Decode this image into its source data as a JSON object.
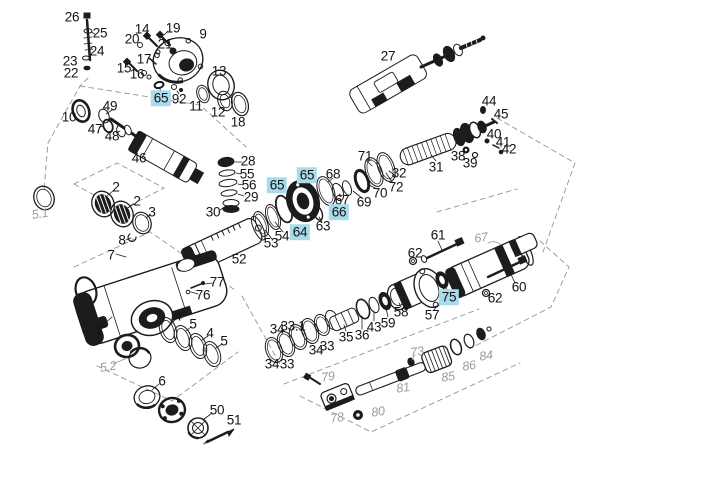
{
  "canvas": {
    "width": 720,
    "height": 501,
    "background": "#ffffff"
  },
  "legend": {
    "highlight_color": "#a9dbec",
    "label_color": "#141414",
    "ghost_label_color": "#9b9b9b",
    "line_color": "#1c1c1c",
    "highlighted_part_numbers": [
      "65",
      "66",
      "64",
      "75"
    ]
  },
  "part_labels": [
    {
      "text": "26",
      "x": 72,
      "y": 17,
      "variant": "normal"
    },
    {
      "text": "25",
      "x": 100,
      "y": 33,
      "variant": "normal"
    },
    {
      "text": "24",
      "x": 97,
      "y": 51,
      "variant": "normal"
    },
    {
      "text": "23",
      "x": 70,
      "y": 61,
      "variant": "normal"
    },
    {
      "text": "22",
      "x": 71,
      "y": 73,
      "variant": "normal"
    },
    {
      "text": "14",
      "x": 142,
      "y": 29,
      "variant": "normal"
    },
    {
      "text": "20",
      "x": 132,
      "y": 39,
      "variant": "normal"
    },
    {
      "text": "19",
      "x": 173,
      "y": 28,
      "variant": "normal"
    },
    {
      "text": "21",
      "x": 165,
      "y": 44,
      "variant": "normal"
    },
    {
      "text": "9",
      "x": 203,
      "y": 34,
      "variant": "normal"
    },
    {
      "text": "17",
      "x": 144,
      "y": 59,
      "variant": "normal"
    },
    {
      "text": "15",
      "x": 124,
      "y": 68,
      "variant": "normal"
    },
    {
      "text": "16",
      "x": 137,
      "y": 74,
      "variant": "normal"
    },
    {
      "text": "13",
      "x": 219,
      "y": 71,
      "variant": "normal"
    },
    {
      "text": "65",
      "x": 161,
      "y": 98,
      "variant": "highlighted"
    },
    {
      "text": "92",
      "x": 179,
      "y": 99,
      "variant": "normal"
    },
    {
      "text": "11",
      "x": 196,
      "y": 106,
      "variant": "normal"
    },
    {
      "text": "12",
      "x": 218,
      "y": 112,
      "variant": "normal"
    },
    {
      "text": "18",
      "x": 238,
      "y": 122,
      "variant": "normal"
    },
    {
      "text": "10",
      "x": 69,
      "y": 117,
      "variant": "normal"
    },
    {
      "text": "49",
      "x": 110,
      "y": 106,
      "variant": "normal"
    },
    {
      "text": "47",
      "x": 95,
      "y": 129,
      "variant": "normal"
    },
    {
      "text": "48",
      "x": 112,
      "y": 136,
      "variant": "normal"
    },
    {
      "text": "46",
      "x": 139,
      "y": 158,
      "variant": "normal"
    },
    {
      "text": "27",
      "x": 388,
      "y": 56,
      "variant": "normal"
    },
    {
      "text": "44",
      "x": 489,
      "y": 101,
      "variant": "normal"
    },
    {
      "text": "45",
      "x": 501,
      "y": 114,
      "variant": "normal"
    },
    {
      "text": "40",
      "x": 494,
      "y": 134,
      "variant": "normal"
    },
    {
      "text": "41",
      "x": 503,
      "y": 142,
      "variant": "normal"
    },
    {
      "text": "42",
      "x": 509,
      "y": 149,
      "variant": "normal"
    },
    {
      "text": "38",
      "x": 458,
      "y": 156,
      "variant": "normal"
    },
    {
      "text": "39",
      "x": 470,
      "y": 163,
      "variant": "normal"
    },
    {
      "text": "31",
      "x": 436,
      "y": 167,
      "variant": "normal"
    },
    {
      "text": "71",
      "x": 365,
      "y": 156,
      "variant": "normal"
    },
    {
      "text": "32",
      "x": 399,
      "y": 173,
      "variant": "normal"
    },
    {
      "text": "72",
      "x": 396,
      "y": 187,
      "variant": "normal"
    },
    {
      "text": "70",
      "x": 380,
      "y": 193,
      "variant": "normal"
    },
    {
      "text": "69",
      "x": 364,
      "y": 202,
      "variant": "normal"
    },
    {
      "text": "68",
      "x": 333,
      "y": 174,
      "variant": "normal"
    },
    {
      "text": "67",
      "x": 342,
      "y": 200,
      "variant": "normal"
    },
    {
      "text": "65",
      "x": 307,
      "y": 175,
      "variant": "highlighted"
    },
    {
      "text": "65",
      "x": 277,
      "y": 185,
      "variant": "highlighted"
    },
    {
      "text": "66",
      "x": 339,
      "y": 212,
      "variant": "highlighted"
    },
    {
      "text": "64",
      "x": 300,
      "y": 232,
      "variant": "highlighted"
    },
    {
      "text": "63",
      "x": 323,
      "y": 226,
      "variant": "normal"
    },
    {
      "text": "54",
      "x": 282,
      "y": 236,
      "variant": "normal"
    },
    {
      "text": "53",
      "x": 271,
      "y": 243,
      "variant": "normal"
    },
    {
      "text": "28",
      "x": 248,
      "y": 161,
      "variant": "normal"
    },
    {
      "text": "55",
      "x": 247,
      "y": 174,
      "variant": "normal"
    },
    {
      "text": "56",
      "x": 249,
      "y": 185,
      "variant": "normal"
    },
    {
      "text": "29",
      "x": 251,
      "y": 197,
      "variant": "normal"
    },
    {
      "text": "30",
      "x": 213,
      "y": 212,
      "variant": "normal"
    },
    {
      "text": "2",
      "x": 116,
      "y": 187,
      "variant": "normal"
    },
    {
      "text": "2",
      "x": 137,
      "y": 201,
      "variant": "normal"
    },
    {
      "text": "3",
      "x": 152,
      "y": 212,
      "variant": "normal"
    },
    {
      "text": "8",
      "x": 122,
      "y": 240,
      "variant": "normal"
    },
    {
      "text": "7",
      "x": 111,
      "y": 255,
      "variant": "normal"
    },
    {
      "text": "52",
      "x": 239,
      "y": 259,
      "variant": "normal"
    },
    {
      "text": "77",
      "x": 217,
      "y": 282,
      "variant": "normal"
    },
    {
      "text": "76",
      "x": 203,
      "y": 295,
      "variant": "normal"
    },
    {
      "text": "61",
      "x": 438,
      "y": 235,
      "variant": "normal"
    },
    {
      "text": "62",
      "x": 415,
      "y": 253,
      "variant": "normal"
    },
    {
      "text": "60",
      "x": 519,
      "y": 287,
      "variant": "normal"
    },
    {
      "text": "62",
      "x": 495,
      "y": 298,
      "variant": "normal"
    },
    {
      "text": "75",
      "x": 449,
      "y": 297,
      "variant": "highlighted"
    },
    {
      "text": "57",
      "x": 432,
      "y": 315,
      "variant": "normal"
    },
    {
      "text": "58",
      "x": 401,
      "y": 312,
      "variant": "normal"
    },
    {
      "text": "59",
      "x": 388,
      "y": 323,
      "variant": "normal"
    },
    {
      "text": "43",
      "x": 374,
      "y": 327,
      "variant": "normal"
    },
    {
      "text": "36",
      "x": 362,
      "y": 335,
      "variant": "normal"
    },
    {
      "text": "35",
      "x": 346,
      "y": 337,
      "variant": "normal"
    },
    {
      "text": "34",
      "x": 277,
      "y": 329,
      "variant": "normal"
    },
    {
      "text": "33.1",
      "x": 293,
      "y": 326,
      "variant": "normal"
    },
    {
      "text": "33",
      "x": 327,
      "y": 346,
      "variant": "normal"
    },
    {
      "text": "34",
      "x": 316,
      "y": 350,
      "variant": "normal"
    },
    {
      "text": "33",
      "x": 287,
      "y": 364,
      "variant": "normal"
    },
    {
      "text": "34",
      "x": 272,
      "y": 364,
      "variant": "normal"
    },
    {
      "text": "1",
      "x": 99,
      "y": 329,
      "variant": "normal"
    },
    {
      "text": "4",
      "x": 178,
      "y": 316,
      "variant": "normal"
    },
    {
      "text": "5",
      "x": 193,
      "y": 324,
      "variant": "normal"
    },
    {
      "text": "4",
      "x": 210,
      "y": 333,
      "variant": "normal"
    },
    {
      "text": "5",
      "x": 224,
      "y": 341,
      "variant": "normal"
    },
    {
      "text": "6",
      "x": 162,
      "y": 381,
      "variant": "normal"
    },
    {
      "text": "50",
      "x": 217,
      "y": 410,
      "variant": "normal"
    },
    {
      "text": "51",
      "x": 234,
      "y": 420,
      "variant": "normal"
    },
    {
      "text": "5.1",
      "x": 40,
      "y": 214,
      "variant": "ghost"
    },
    {
      "text": "5.2",
      "x": 108,
      "y": 367,
      "variant": "ghost"
    },
    {
      "text": "67",
      "x": 481,
      "y": 238,
      "variant": "ghost"
    },
    {
      "text": "73",
      "x": 417,
      "y": 352,
      "variant": "ghost"
    },
    {
      "text": "79",
      "x": 328,
      "y": 377,
      "variant": "ghost"
    },
    {
      "text": "81",
      "x": 403,
      "y": 388,
      "variant": "ghost"
    },
    {
      "text": "85",
      "x": 448,
      "y": 377,
      "variant": "ghost"
    },
    {
      "text": "86",
      "x": 469,
      "y": 366,
      "variant": "ghost"
    },
    {
      "text": "84",
      "x": 486,
      "y": 356,
      "variant": "ghost"
    },
    {
      "text": "80",
      "x": 378,
      "y": 412,
      "variant": "ghost"
    },
    {
      "text": "78",
      "x": 337,
      "y": 418,
      "variant": "ghost"
    }
  ]
}
